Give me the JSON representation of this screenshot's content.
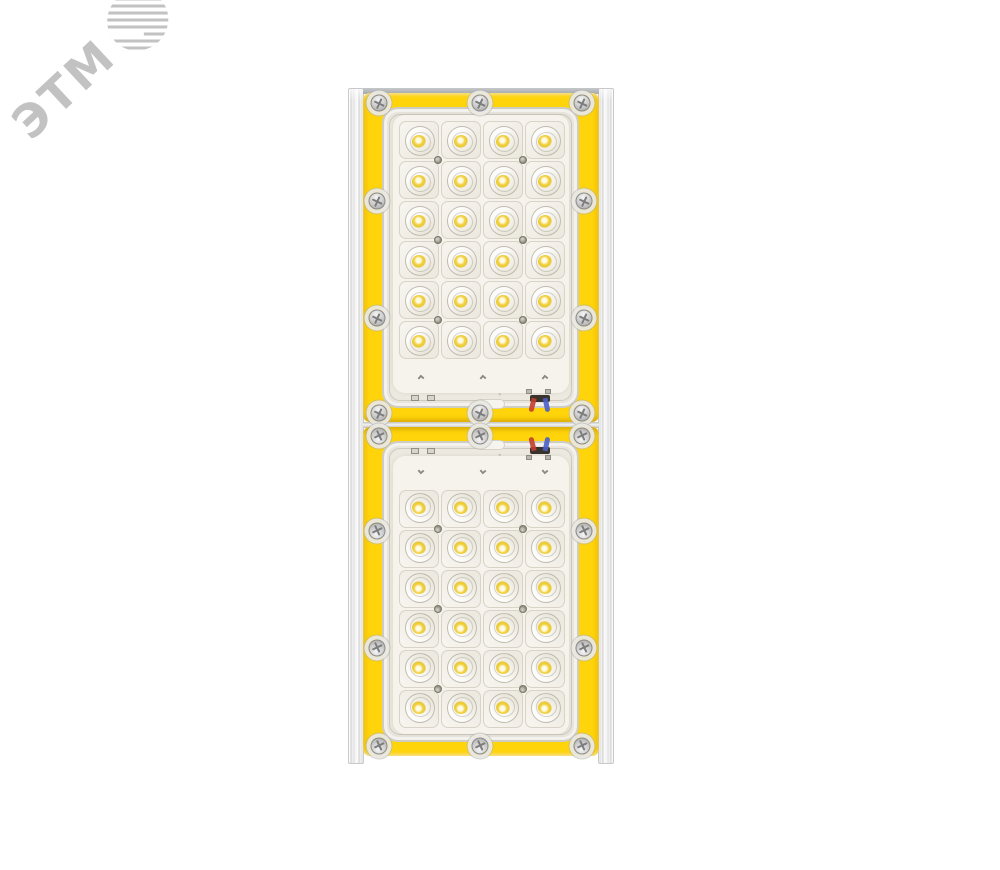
{
  "watermark": {
    "text": "ЭТМ",
    "icon": "etm-striped-globe-icon",
    "color": "#c2c2c2"
  },
  "fixture": {
    "modules": [
      {
        "name": "module-top",
        "led_rows": 6,
        "led_cols": 4,
        "leds": 24,
        "frame_screws": 10,
        "wire_zone": "bottom"
      },
      {
        "name": "module-bottom",
        "led_rows": 6,
        "led_cols": 4,
        "leds": 24,
        "frame_screws": 10,
        "wire_zone": "top"
      }
    ],
    "colors": {
      "background": "#ffffff",
      "frame_yellow": "#ffd40a",
      "lens_panel": "#edeae2",
      "pcb_white": "#f5f3ec",
      "cell_border": "#d8d3c6",
      "led_yellow": "#f3d344",
      "rail_silver": "#ececec",
      "wire_red": "#c23f2e",
      "wire_blue": "#4a5fc9",
      "watermark_gray": "#c2c2c2"
    }
  }
}
